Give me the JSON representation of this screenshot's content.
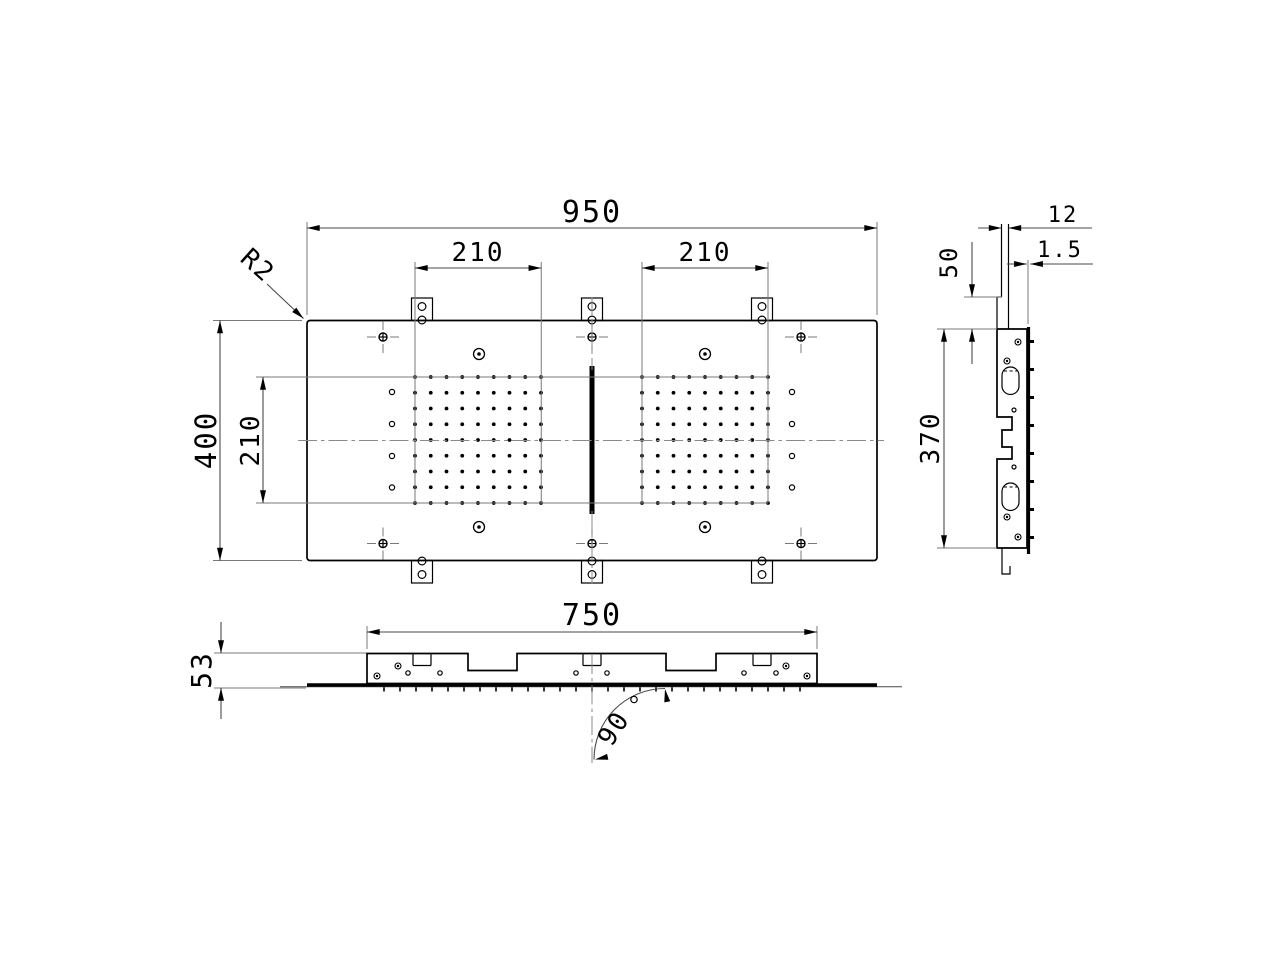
{
  "drawing_type": "engineering-dimension-drawing",
  "dimensions": {
    "top_view": {
      "overall_width": "950",
      "overall_height": "400",
      "nozzle_field_width_left": "210",
      "nozzle_field_width_right": "210",
      "nozzle_field_height": "210",
      "corner_radius": "R2"
    },
    "side_view": {
      "flange_depth": "12",
      "panel_thickness": "1.5",
      "flange_offset": "50",
      "body_height": "370"
    },
    "front_view": {
      "frame_width": "750",
      "overall_depth": "53",
      "spray_angle": "90",
      "spray_angle_unit": "°"
    }
  },
  "nozzle_grid": {
    "rows": 9,
    "cols": 9,
    "grid_count": 2
  },
  "colors": {
    "line": "#000000",
    "thin_line": "#787878",
    "background": "#ffffff"
  }
}
